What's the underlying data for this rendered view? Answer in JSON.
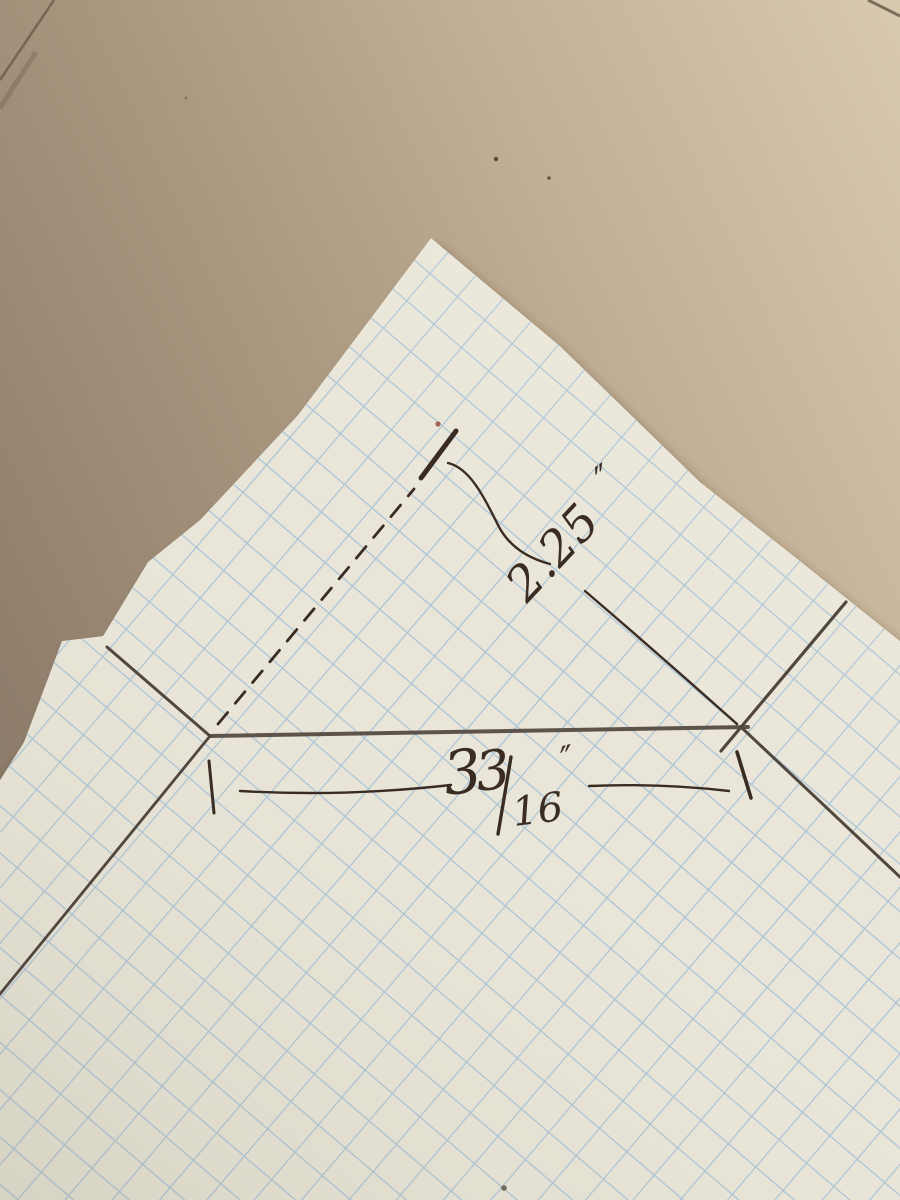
{
  "photo": {
    "subject": "Hand-drawn dimension sketch on graph paper over cardboard",
    "surface": "cardboard",
    "paper_type": "graph-paper"
  },
  "colors": {
    "cardboard_dark": "#8e7c6a",
    "cardboard_mid": "#b3a089",
    "cardboard_light": "#d9c9ae",
    "paper": "#e9e6d9",
    "grid_blue": "#9dbcd6",
    "pencil": "#51473e",
    "ink": "#3a2c22",
    "red_tip": "#9a4b38"
  },
  "measurements": {
    "diagonal": {
      "value": "2.25",
      "unit": "″",
      "display": "2.25″"
    },
    "base": {
      "whole": "3",
      "numerator": "3",
      "slash": "/",
      "denominator": "16",
      "unit": "″",
      "display": "3 3/16″"
    }
  }
}
